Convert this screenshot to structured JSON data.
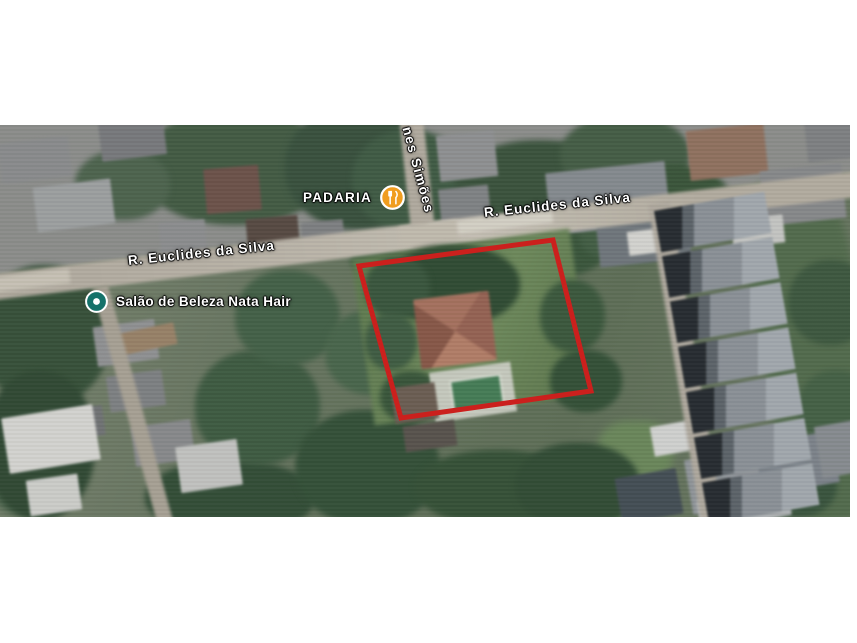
{
  "map": {
    "kind": "satellite",
    "streets": {
      "euclides_left": "R. Euclides da Silva",
      "euclides_right": "R. Euclides da Silva",
      "simoes": "nes Simões"
    },
    "pois": [
      {
        "label": "PADARIA",
        "icon": "restaurant-icon",
        "icon_color": "#f09d1f"
      },
      {
        "label": "Salão de Beleza Nata Hair",
        "icon": "beauty-salon-icon",
        "icon_color": "#15726a"
      }
    ],
    "property_outline": {
      "color": "#cb201d"
    }
  }
}
